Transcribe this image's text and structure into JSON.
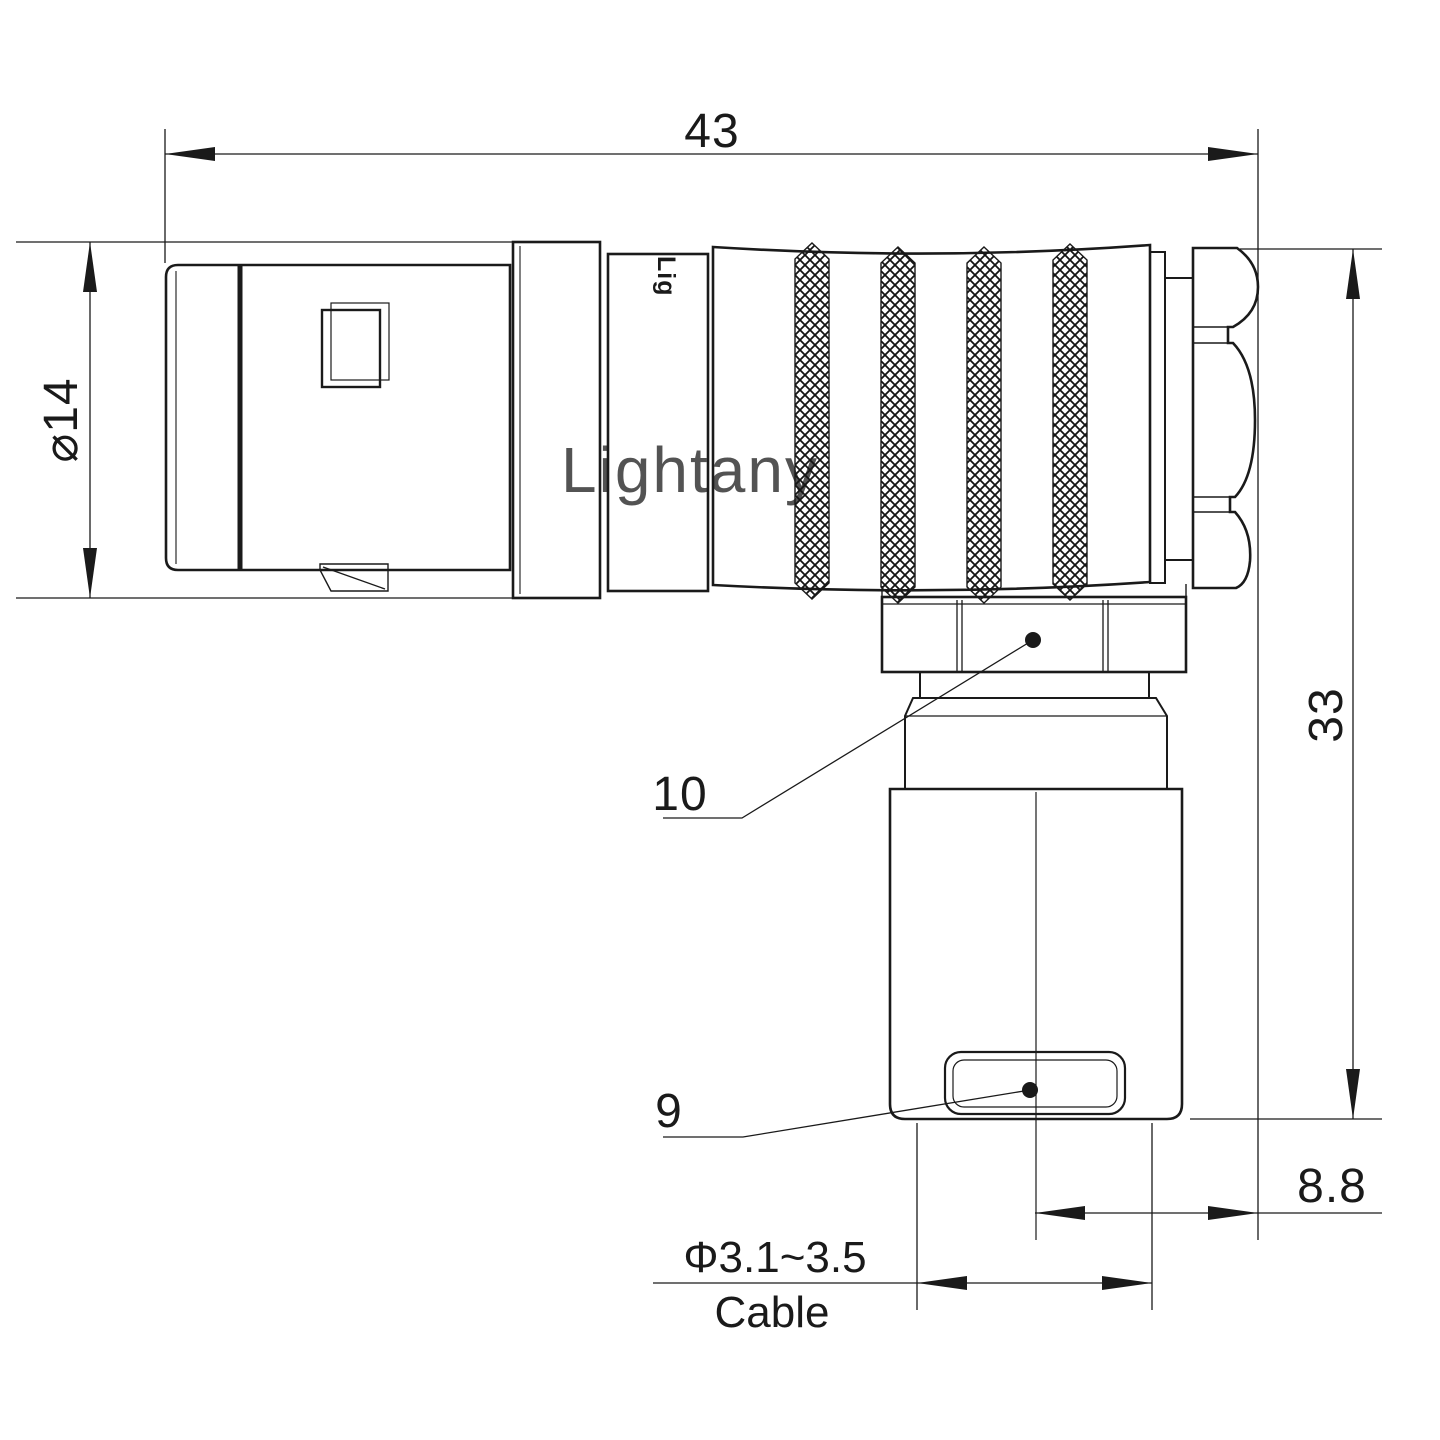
{
  "drawing": {
    "watermark": "Lightany",
    "shell_print": "Lig",
    "dims": {
      "length": "43",
      "diameter": "⌀14",
      "height": "33",
      "offset": "8.8",
      "cable_dia": "Φ3.1~3.5",
      "cable_word": "Cable",
      "label_nut": "10",
      "label_crimp": "9"
    },
    "colors": {
      "line": "#1a1a1a",
      "watermark": "#f2c0c4",
      "bg": "#ffffff"
    }
  }
}
